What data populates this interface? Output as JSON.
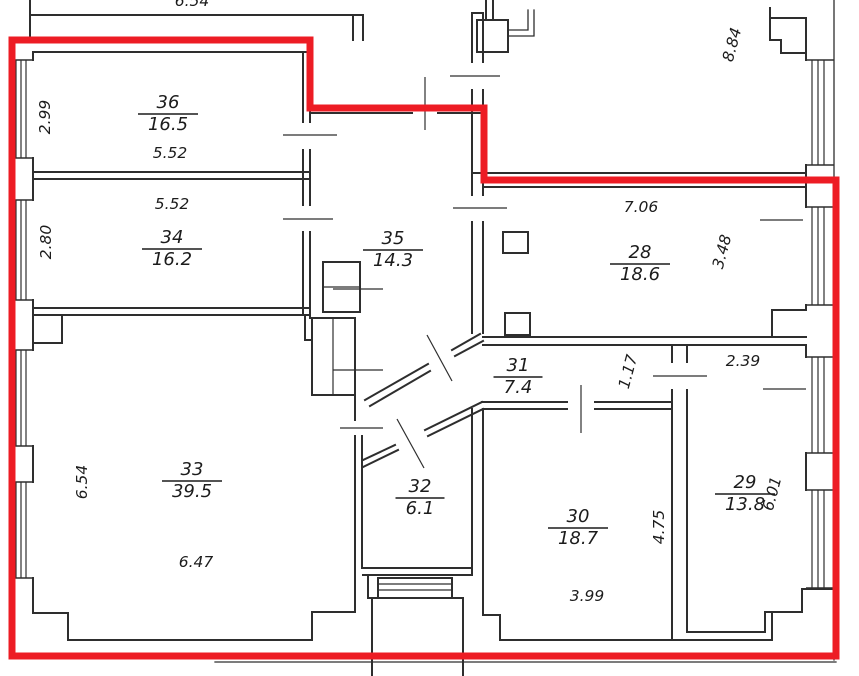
{
  "colors": {
    "wall": "#2e2e2e",
    "text": "#1c1c1c",
    "red_outline": "#ED1C24",
    "background": "#ffffff"
  },
  "rooms": [
    {
      "number": "36",
      "area": "16.5",
      "cx": 168,
      "cy": 113
    },
    {
      "number": "34",
      "area": "16.2",
      "cx": 172,
      "cy": 248
    },
    {
      "number": "35",
      "area": "14.3",
      "cx": 393,
      "cy": 249
    },
    {
      "number": "28",
      "area": "18.6",
      "cx": 640,
      "cy": 263
    },
    {
      "number": "31",
      "area": "7.4",
      "cx": 518,
      "cy": 376
    },
    {
      "number": "32",
      "area": "6.1",
      "cx": 420,
      "cy": 497
    },
    {
      "number": "33",
      "area": "39.5",
      "cx": 192,
      "cy": 480
    },
    {
      "number": "30",
      "area": "18.7",
      "cx": 578,
      "cy": 527
    },
    {
      "number": "29",
      "area": "13.8",
      "cx": 745,
      "cy": 493
    }
  ],
  "dimensions": [
    {
      "text": "2.99",
      "x": 50,
      "y": 117,
      "rot": -90
    },
    {
      "text": "5.52",
      "x": 170,
      "y": 158,
      "rot": 0
    },
    {
      "text": "5.52",
      "x": 172,
      "y": 209,
      "rot": 0
    },
    {
      "text": "2.80",
      "x": 51,
      "y": 242,
      "rot": -90
    },
    {
      "text": "8.84",
      "x": 737,
      "y": 46,
      "rot": -75
    },
    {
      "text": "7.06",
      "x": 641,
      "y": 212,
      "rot": 0
    },
    {
      "text": "3.48",
      "x": 727,
      "y": 253,
      "rot": -75
    },
    {
      "text": "1.17",
      "x": 633,
      "y": 373,
      "rot": -75
    },
    {
      "text": "2.39",
      "x": 743,
      "y": 366,
      "rot": 0
    },
    {
      "text": "6.01",
      "x": 777,
      "y": 495,
      "rot": -75
    },
    {
      "text": "4.75",
      "x": 664,
      "y": 527,
      "rot": -90
    },
    {
      "text": "6.54",
      "x": 87,
      "y": 482,
      "rot": -90
    },
    {
      "text": "6.47",
      "x": 196,
      "y": 567,
      "rot": 0
    },
    {
      "text": "3.99",
      "x": 587,
      "y": 601,
      "rot": 0
    },
    {
      "text": "6.54",
      "x": 192,
      "y": 6,
      "rot": 0
    }
  ],
  "red_outline": {
    "width": 7,
    "points": [
      [
        12,
        40
      ],
      [
        310,
        40
      ],
      [
        310,
        108
      ],
      [
        484,
        108
      ],
      [
        484,
        180
      ],
      [
        836,
        180
      ],
      [
        836,
        656
      ],
      [
        12,
        656
      ]
    ]
  },
  "walls": [
    {
      "p": [
        [
          33,
          52
        ],
        [
          310,
          52
        ]
      ]
    },
    {
      "p": [
        [
          33,
          172
        ],
        [
          310,
          172
        ]
      ]
    },
    {
      "p": [
        [
          33,
          179
        ],
        [
          310,
          179
        ]
      ]
    },
    {
      "p": [
        [
          33,
          308
        ],
        [
          310,
          308
        ]
      ]
    },
    {
      "p": [
        [
          33,
          315
        ],
        [
          310,
          315
        ]
      ]
    },
    {
      "p": [
        [
          303,
          52
        ],
        [
          303,
          122
        ]
      ]
    },
    {
      "p": [
        [
          303,
          150
        ],
        [
          303,
          205
        ]
      ]
    },
    {
      "p": [
        [
          303,
          232
        ],
        [
          303,
          315
        ]
      ]
    },
    {
      "p": [
        [
          310,
          52
        ],
        [
          310,
          122
        ]
      ]
    },
    {
      "p": [
        [
          310,
          150
        ],
        [
          310,
          205
        ]
      ]
    },
    {
      "p": [
        [
          310,
          232
        ],
        [
          310,
          318
        ]
      ]
    },
    {
      "p": [
        [
          310,
          113
        ],
        [
          412,
          113
        ]
      ]
    },
    {
      "p": [
        [
          438,
          113
        ],
        [
          483,
          113
        ]
      ]
    },
    {
      "p": [
        [
          472,
          13
        ],
        [
          472,
          62
        ]
      ]
    },
    {
      "p": [
        [
          472,
          90
        ],
        [
          472,
          195
        ]
      ]
    },
    {
      "p": [
        [
          472,
          222
        ],
        [
          472,
          333
        ]
      ]
    },
    {
      "p": [
        [
          483,
          13
        ],
        [
          483,
          62
        ]
      ]
    },
    {
      "p": [
        [
          483,
          90
        ],
        [
          483,
          195
        ]
      ]
    },
    {
      "p": [
        [
          483,
          222
        ],
        [
          483,
          333
        ]
      ]
    },
    {
      "p": [
        [
          472,
          13
        ],
        [
          483,
          13
        ]
      ]
    },
    {
      "p": [
        [
          473,
          173
        ],
        [
          806,
          173
        ]
      ]
    },
    {
      "p": [
        [
          483,
          187
        ],
        [
          806,
          187
        ]
      ]
    },
    {
      "p": [
        [
          483,
          337
        ],
        [
          806,
          337
        ]
      ]
    },
    {
      "p": [
        [
          483,
          345
        ],
        [
          806,
          345
        ]
      ]
    },
    {
      "p": [
        [
          482,
          402
        ],
        [
          567,
          402
        ]
      ]
    },
    {
      "p": [
        [
          595,
          402
        ],
        [
          672,
          402
        ]
      ]
    },
    {
      "p": [
        [
          483,
          409
        ],
        [
          567,
          409
        ]
      ]
    },
    {
      "p": [
        [
          595,
          409
        ],
        [
          672,
          409
        ]
      ]
    },
    {
      "p": [
        [
          672,
          345
        ],
        [
          672,
          362
        ]
      ]
    },
    {
      "p": [
        [
          672,
          390
        ],
        [
          672,
          640
        ]
      ]
    },
    {
      "p": [
        [
          687,
          345
        ],
        [
          687,
          362
        ]
      ]
    },
    {
      "p": [
        [
          687,
          390
        ],
        [
          687,
          632
        ]
      ]
    },
    {
      "p": [
        [
          472,
          409
        ],
        [
          472,
          575
        ]
      ]
    },
    {
      "p": [
        [
          483,
          409
        ],
        [
          483,
          615
        ]
      ]
    },
    {
      "p": [
        [
          483,
          615
        ],
        [
          500,
          615
        ]
      ]
    },
    {
      "p": [
        [
          500,
          615
        ],
        [
          500,
          640
        ]
      ]
    },
    {
      "p": [
        [
          500,
          640
        ],
        [
          772,
          640
        ]
      ]
    },
    {
      "p": [
        [
          363,
          568
        ],
        [
          472,
          568
        ]
      ]
    },
    {
      "p": [
        [
          363,
          575
        ],
        [
          472,
          575
        ]
      ]
    },
    {
      "p": [
        [
          355,
          318
        ],
        [
          355,
          362
        ]
      ]
    },
    {
      "p": [
        [
          355,
          378
        ],
        [
          355,
          420
        ]
      ]
    },
    {
      "p": [
        [
          355,
          436
        ],
        [
          355,
          612
        ]
      ]
    },
    {
      "p": [
        [
          362,
          436
        ],
        [
          362,
          568
        ]
      ]
    },
    {
      "p": [
        [
          33,
          343
        ],
        [
          62,
          343
        ]
      ]
    },
    {
      "p": [
        [
          62,
          343
        ],
        [
          62,
          315
        ]
      ]
    },
    {
      "p": [
        [
          305,
          315
        ],
        [
          305,
          340
        ]
      ]
    },
    {
      "p": [
        [
          305,
          340
        ],
        [
          312,
          340
        ]
      ]
    },
    {
      "p": [
        [
          33,
          613
        ],
        [
          68,
          613
        ]
      ]
    },
    {
      "p": [
        [
          68,
          613
        ],
        [
          68,
          640
        ]
      ]
    },
    {
      "p": [
        [
          68,
          640
        ],
        [
          312,
          640
        ]
      ]
    },
    {
      "p": [
        [
          312,
          640
        ],
        [
          312,
          612
        ]
      ]
    },
    {
      "p": [
        [
          312,
          612
        ],
        [
          355,
          612
        ]
      ]
    },
    {
      "p": [
        [
          687,
          632
        ],
        [
          765,
          632
        ]
      ]
    },
    {
      "p": [
        [
          765,
          632
        ],
        [
          765,
          612
        ]
      ]
    },
    {
      "p": [
        [
          765,
          612
        ],
        [
          802,
          612
        ]
      ]
    },
    {
      "p": [
        [
          833,
          589
        ],
        [
          802,
          589
        ]
      ]
    },
    {
      "p": [
        [
          802,
          589
        ],
        [
          802,
          612
        ]
      ]
    },
    {
      "p": [
        [
          772,
          612
        ],
        [
          772,
          640
        ]
      ]
    },
    {
      "p": [
        [
          806,
          310
        ],
        [
          772,
          310
        ]
      ]
    },
    {
      "p": [
        [
          772,
          310
        ],
        [
          772,
          337
        ]
      ]
    },
    {
      "p": [
        [
          770,
          8
        ],
        [
          770,
          40
        ]
      ]
    },
    {
      "p": [
        [
          770,
          40
        ],
        [
          781,
          40
        ]
      ]
    },
    {
      "p": [
        [
          781,
          40
        ],
        [
          781,
          53
        ]
      ]
    },
    {
      "p": [
        [
          781,
          53
        ],
        [
          806,
          53
        ]
      ]
    },
    {
      "p": [
        [
          770,
          18
        ],
        [
          806,
          18
        ]
      ]
    },
    {
      "p": [
        [
          806,
          18
        ],
        [
          806,
          60
        ]
      ]
    },
    {
      "p": [
        [
          806,
          165
        ],
        [
          806,
          207
        ]
      ]
    },
    {
      "p": [
        [
          806,
          305
        ],
        [
          806,
          310
        ]
      ]
    },
    {
      "p": [
        [
          806,
          345
        ],
        [
          806,
          357
        ]
      ]
    },
    {
      "p": [
        [
          806,
          453
        ],
        [
          806,
          490
        ]
      ]
    },
    {
      "p": [
        [
          30,
          0
        ],
        [
          30,
          40
        ]
      ]
    },
    {
      "p": [
        [
          30,
          15
        ],
        [
          363,
          15
        ]
      ]
    },
    {
      "p": [
        [
          353,
          15
        ],
        [
          353,
          40
        ]
      ]
    },
    {
      "p": [
        [
          363,
          15
        ],
        [
          363,
          40
        ]
      ]
    },
    {
      "p": [
        [
          486,
          0
        ],
        [
          486,
          20
        ]
      ]
    },
    {
      "p": [
        [
          493,
          0
        ],
        [
          493,
          20
        ]
      ]
    },
    {
      "p": [
        [
          365,
          400
        ],
        [
          428,
          364
        ]
      ]
    },
    {
      "p": [
        [
          452,
          350
        ],
        [
          480,
          334
        ]
      ]
    },
    {
      "p": [
        [
          370,
          406
        ],
        [
          430,
          371
        ]
      ]
    },
    {
      "p": [
        [
          455,
          356
        ],
        [
          483,
          341
        ]
      ]
    },
    {
      "p": [
        [
          363,
          460
        ],
        [
          395,
          445
        ]
      ]
    },
    {
      "p": [
        [
          425,
          430
        ],
        [
          482,
          402
        ]
      ]
    },
    {
      "p": [
        [
          363,
          467
        ],
        [
          398,
          450
        ]
      ]
    },
    {
      "p": [
        [
          428,
          436
        ],
        [
          483,
          409
        ]
      ]
    },
    {
      "p": [
        [
          368,
          575
        ],
        [
          368,
          598
        ]
      ]
    },
    {
      "p": [
        [
          368,
          598
        ],
        [
          378,
          598
        ]
      ]
    },
    {
      "p": [
        [
          372,
          598
        ],
        [
          372,
          676
        ]
      ]
    },
    {
      "p": [
        [
          463,
          598
        ],
        [
          463,
          676
        ]
      ]
    },
    {
      "p": [
        [
          452,
          598
        ],
        [
          463,
          598
        ]
      ]
    },
    {
      "p": [
        [
          378,
          584
        ],
        [
          452,
          584
        ]
      ],
      "w": 1.2
    },
    {
      "p": [
        [
          378,
          590
        ],
        [
          452,
          590
        ]
      ],
      "w": 1.2
    },
    {
      "p": [
        [
          323,
          287
        ],
        [
          360,
          287
        ]
      ],
      "w": 1.2
    },
    {
      "p": [
        [
          333,
          318
        ],
        [
          333,
          395
        ]
      ],
      "w": 1.2
    },
    {
      "p": [
        [
          508,
          30
        ],
        [
          528,
          30
        ],
        [
          528,
          10
        ]
      ],
      "w": 1.3
    },
    {
      "p": [
        [
          508,
          36
        ],
        [
          534,
          36
        ],
        [
          534,
          10
        ]
      ],
      "w": 1.3
    },
    {
      "p": [
        [
          215,
          662
        ],
        [
          836,
          662
        ]
      ],
      "w": 1.3
    },
    {
      "p": [
        [
          13,
          40
        ],
        [
          13,
          656
        ]
      ],
      "w": 1.3
    },
    {
      "p": [
        [
          834,
          0
        ],
        [
          834,
          660
        ]
      ],
      "w": 1.3
    },
    {
      "p": [
        [
          33,
          52
        ],
        [
          33,
          60
        ]
      ]
    },
    {
      "p": [
        [
          33,
          158
        ],
        [
          33,
          200
        ]
      ]
    },
    {
      "p": [
        [
          33,
          300
        ],
        [
          33,
          350
        ]
      ]
    },
    {
      "p": [
        [
          33,
          446
        ],
        [
          33,
          482
        ]
      ]
    },
    {
      "p": [
        [
          33,
          578
        ],
        [
          33,
          613
        ]
      ]
    }
  ],
  "boxes": [
    {
      "x": 477,
      "y": 20,
      "w": 31,
      "h": 32
    },
    {
      "x": 503,
      "y": 232,
      "w": 25,
      "h": 21
    },
    {
      "x": 505,
      "y": 313,
      "w": 25,
      "h": 22
    },
    {
      "x": 323,
      "y": 262,
      "w": 37,
      "h": 50
    },
    {
      "x": 312,
      "y": 318,
      "w": 43,
      "h": 77
    },
    {
      "x": 378,
      "y": 578,
      "w": 74,
      "h": 20
    }
  ],
  "windows": {
    "left": {
      "face_x": [
        13,
        33
      ],
      "line_x": [
        16,
        21,
        26
      ],
      "spans": [
        [
          60,
          158
        ],
        [
          200,
          300
        ],
        [
          350,
          446
        ],
        [
          482,
          578
        ]
      ]
    },
    "right": {
      "face_x": [
        806,
        834
      ],
      "line_x": [
        812,
        818,
        824
      ],
      "spans": [
        [
          60,
          165
        ],
        [
          207,
          305
        ],
        [
          357,
          453
        ],
        [
          490,
          588
        ]
      ]
    }
  },
  "door_ticks": [
    {
      "p": [
        [
          283,
          135
        ],
        [
          337,
          135
        ]
      ]
    },
    {
      "p": [
        [
          283,
          219
        ],
        [
          333,
          219
        ]
      ]
    },
    {
      "p": [
        [
          450,
          76
        ],
        [
          500,
          76
        ]
      ]
    },
    {
      "p": [
        [
          425,
          77
        ],
        [
          425,
          130
        ]
      ]
    },
    {
      "p": [
        [
          453,
          208
        ],
        [
          507,
          208
        ]
      ]
    },
    {
      "p": [
        [
          581,
          385
        ],
        [
          581,
          433
        ]
      ]
    },
    {
      "p": [
        [
          653,
          376
        ],
        [
          707,
          376
        ]
      ]
    },
    {
      "p": [
        [
          333,
          289
        ],
        [
          383,
          289
        ]
      ]
    },
    {
      "p": [
        [
          333,
          370
        ],
        [
          383,
          370
        ]
      ]
    },
    {
      "p": [
        [
          340,
          428
        ],
        [
          383,
          428
        ]
      ]
    },
    {
      "p": [
        [
          760,
          220
        ],
        [
          803,
          220
        ]
      ]
    },
    {
      "p": [
        [
          763,
          389
        ],
        [
          806,
          389
        ]
      ]
    },
    {
      "p": [
        [
          427,
          335
        ],
        [
          452,
          381
        ]
      ]
    },
    {
      "p": [
        [
          397,
          419
        ],
        [
          424,
          468
        ]
      ]
    }
  ]
}
